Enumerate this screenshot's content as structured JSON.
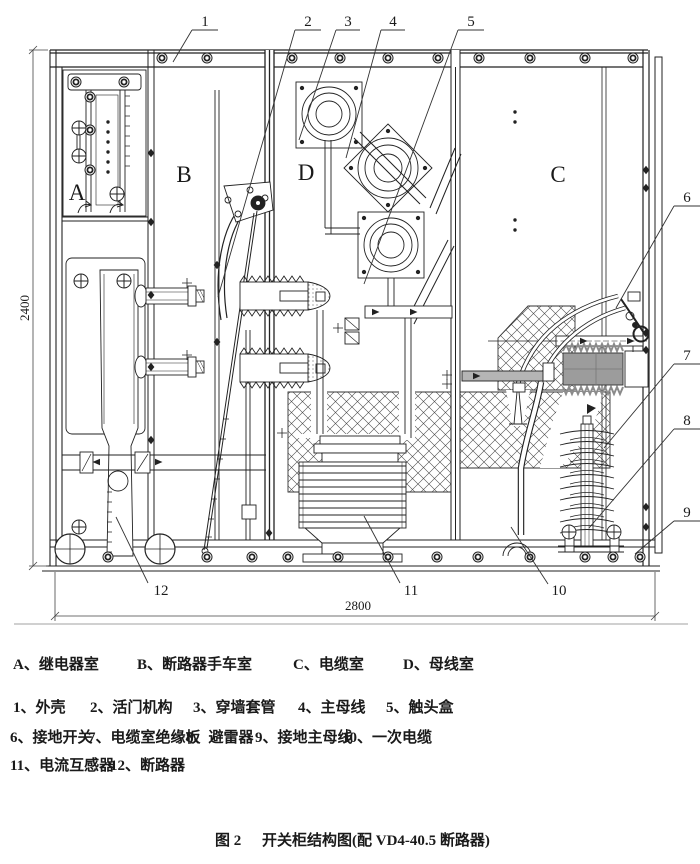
{
  "diagram": {
    "letters": {
      "a": "A",
      "b": "B",
      "c": "C",
      "d": "D"
    },
    "callouts": {
      "c1": "1",
      "c2": "2",
      "c3": "3",
      "c4": "4",
      "c5": "5",
      "c6": "6",
      "c7": "7",
      "c8": "8",
      "c9": "9",
      "c10": "10",
      "c11": "11",
      "c12": "12"
    },
    "dimensions": {
      "height": "2400",
      "width": "2800"
    },
    "colors": {
      "ink": "#1a1a1a",
      "paper": "#ffffff",
      "shade": "#9c9c9c"
    }
  },
  "legend": {
    "compartments": [
      "A、继电器室",
      "B、断路器手车室",
      "C、电缆室",
      "D、母线室"
    ],
    "row2": [
      "1、外壳",
      "2、活门机构",
      "3、穿墙套管",
      "4、主母线",
      "5、触头盒"
    ],
    "row3": [
      "6、接地开关",
      "7、电缆室绝缘板",
      "8、避雷器",
      "9、接地主母线",
      "10、一次电缆"
    ],
    "row4": [
      "11、电流互感器",
      "12、断路器"
    ]
  },
  "caption": {
    "fig": "图 2",
    "text": "开关柜结构图(配 VD4-40.5 断路器)"
  }
}
